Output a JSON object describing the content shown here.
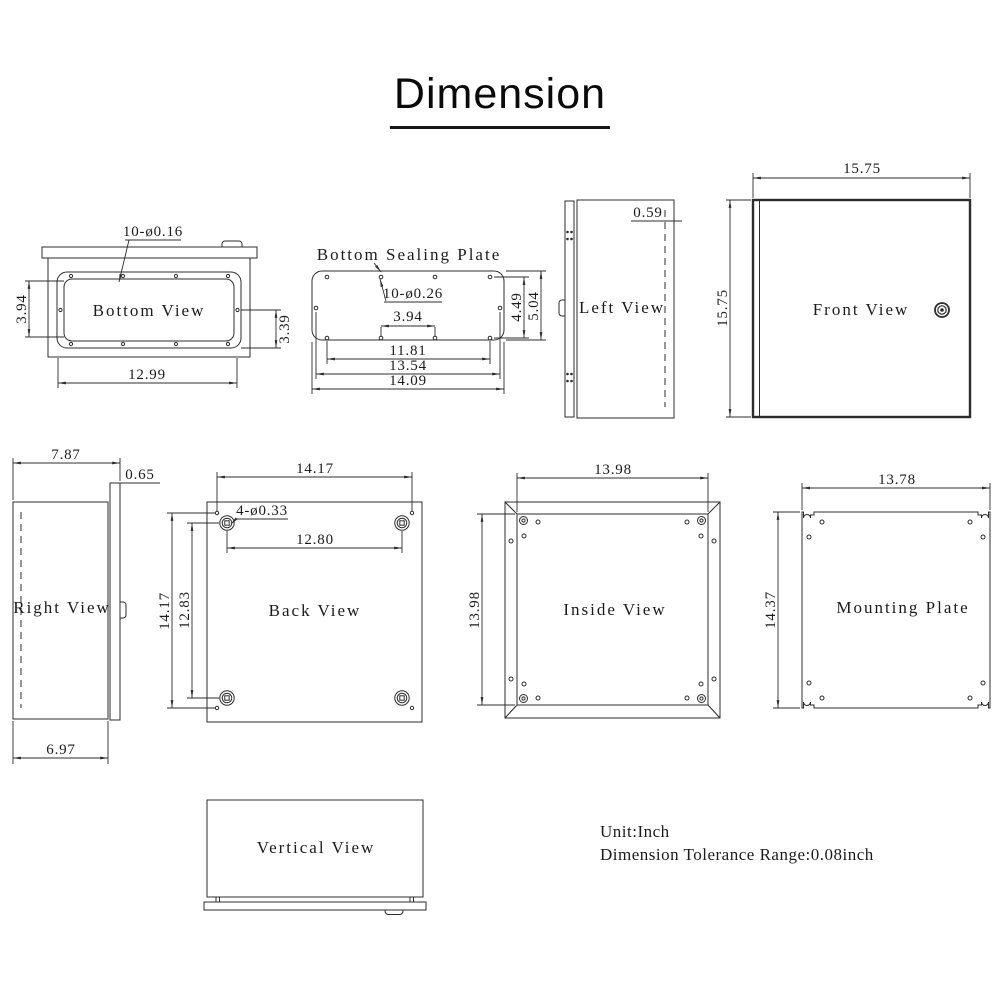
{
  "title": "Dimension",
  "notes": {
    "unit": "Unit:Inch",
    "tolerance": "Dimension Tolerance Range:0.08inch"
  },
  "colors": {
    "ink": "#2c2c2c",
    "text": "#1b1b1b",
    "background": "#ffffff"
  },
  "views": {
    "bottom": {
      "label": "Bottom View",
      "hole_note": "10-ø0.16",
      "width": "12.99",
      "inner_height": "3.94",
      "flange_height": "3.39"
    },
    "sealing_plate": {
      "label": "Bottom Sealing Plate",
      "hole_note": "10-ø0.26",
      "center_holes": "3.94",
      "hole_span": "11.81",
      "side_hole_span": "13.54",
      "plate_width": "14.09",
      "hole_height": "4.49",
      "plate_height": "5.04"
    },
    "left": {
      "label": "Left View",
      "door_offset": "0.59"
    },
    "front": {
      "label": "Front View",
      "width": "15.75",
      "height": "15.75"
    },
    "right": {
      "label": "Right View",
      "depth_total": "7.87",
      "door_depth": "0.65",
      "body_depth": "6.97"
    },
    "back": {
      "label": "Back View",
      "hole_note": "4-ø0.33",
      "mount_width": "14.17",
      "boss_width": "12.80",
      "mount_height": "14.17",
      "boss_height": "12.83"
    },
    "inside": {
      "label": "Inside View",
      "width": "13.98",
      "height": "13.98"
    },
    "mounting_plate": {
      "label": "Mounting Plate",
      "width": "13.78",
      "height": "14.37"
    },
    "vertical": {
      "label": "Vertical View"
    }
  }
}
